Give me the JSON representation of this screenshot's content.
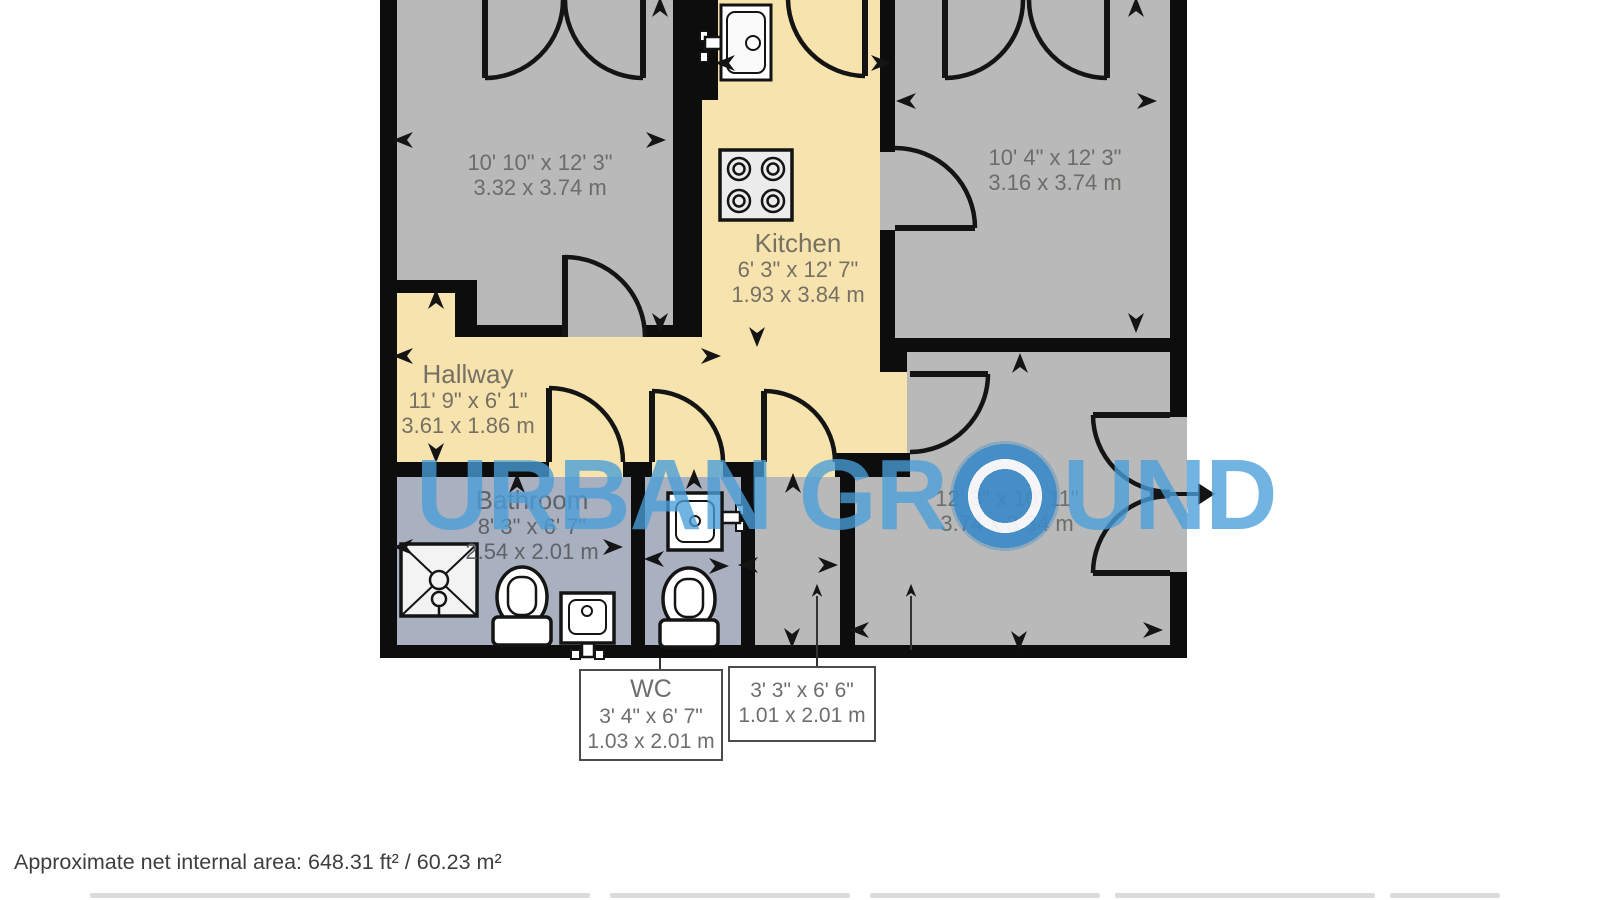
{
  "watermark": {
    "part1": "URBAN GR",
    "part2": "UND"
  },
  "rooms": {
    "bedroom1": {
      "dims_imperial": "10' 10\" x 12' 3\"",
      "dims_metric": "3.32 x 3.74 m"
    },
    "kitchen": {
      "name": "Kitchen",
      "dims_imperial": "6' 3\" x 12' 7\"",
      "dims_metric": "1.93 x 3.84 m"
    },
    "bedroom2": {
      "dims_imperial": "10' 4\" x 12' 3\"",
      "dims_metric": "3.16 x 3.74 m"
    },
    "hallway": {
      "name": "Hallway",
      "dims_imperial": "11' 9\" x 6' 1\"",
      "dims_metric": "3.61 x 1.86 m"
    },
    "bathroom": {
      "name": "Bathroom",
      "dims_imperial": "8' 3\" x 6' 7\"",
      "dims_metric": "2.54 x 2.01 m"
    },
    "wc": {
      "name": "WC",
      "dims_imperial": "3' 4\" x 6' 7\"",
      "dims_metric": "1.03 x 2.01 m"
    },
    "store": {
      "dims_imperial": "3' 3\" x 6' 6\"",
      "dims_metric": "1.01 x 2.01 m"
    },
    "reception": {
      "dims_imperial": "12' 3\" x 10' 11\"",
      "dims_metric": "3.74 x 3.34 m"
    }
  },
  "footer": {
    "area_note": "Approximate net internal area: 648.31 ft² / 60.23 m²"
  },
  "colors": {
    "wall": "#0d0d0d",
    "room_gray": "#b9b9b9",
    "room_yellow": "#f7e3ae",
    "bathroom_blue": "#a9b0bf",
    "watermark_blue": "#499dd9",
    "label_gray": "#6c6c68"
  }
}
